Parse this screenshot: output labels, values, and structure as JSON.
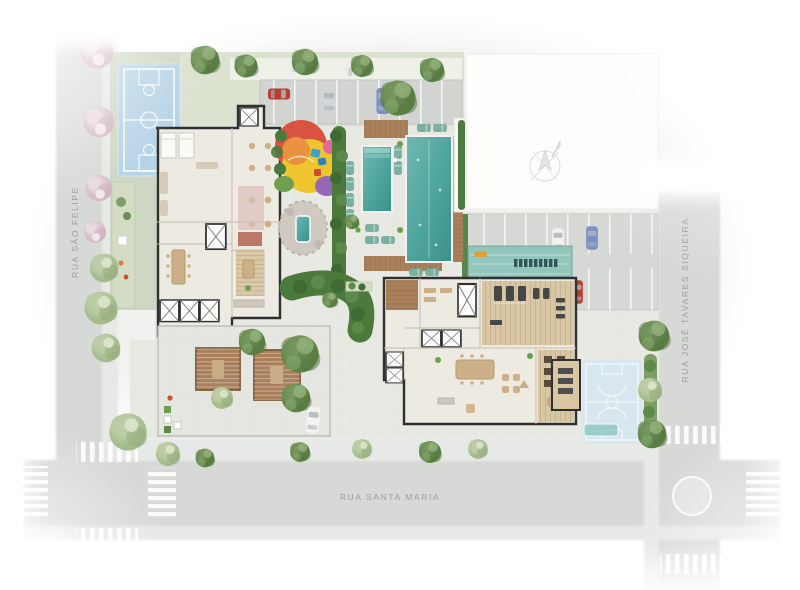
{
  "streets": {
    "left": {
      "label": "RUA SÃO FELIPE"
    },
    "right": {
      "label": "RUA JOSÉ TAVARES SIQUEIRA"
    },
    "bottom": {
      "label": "RUA SANTA MARIA"
    }
  },
  "landmarks": [
    "sports-court",
    "top-parking",
    "right-parking",
    "playground",
    "kids-pool",
    "lap-pool",
    "spa-water-feature",
    "gym",
    "party-room",
    "lounge-room",
    "pergola-terrace",
    "bike-shelter",
    "storage-room",
    "practice-court",
    "elevator-cores",
    "compass-rose",
    "crosswalks",
    "roundabout"
  ],
  "colors": {
    "street": "#d7d9d7",
    "sidewalk": "#e7e9e6",
    "paving": "#e9e9e4",
    "grass": "#ced7c3",
    "grass_light": "#dbe2d0",
    "court_blue": "#b7d3e7",
    "court_faded": "#d4e6f4",
    "pool": "#4da49d",
    "pool_light": "#8cc8c2",
    "wood": "#a9805a",
    "wood_light": "#d9c6a2",
    "floor": "#edeae1",
    "wall": "#2f2f2f",
    "hedge": "#4c7a3c",
    "foliage": "#7c9f67",
    "blossom": "#e4d2d8",
    "playground_yellow": "#eec42f",
    "playground_red": "#d85340",
    "playground_orange": "#e8923f",
    "playground_purple": "#9468b4",
    "playground_pink": "#e0689a",
    "playground_green": "#6f9e4f",
    "glass": "#8fc5ba",
    "car_red": "#b73f32",
    "car_blue": "#7b90c4",
    "car_silver": "#d3d6d8",
    "label": "#9c9e9c"
  }
}
